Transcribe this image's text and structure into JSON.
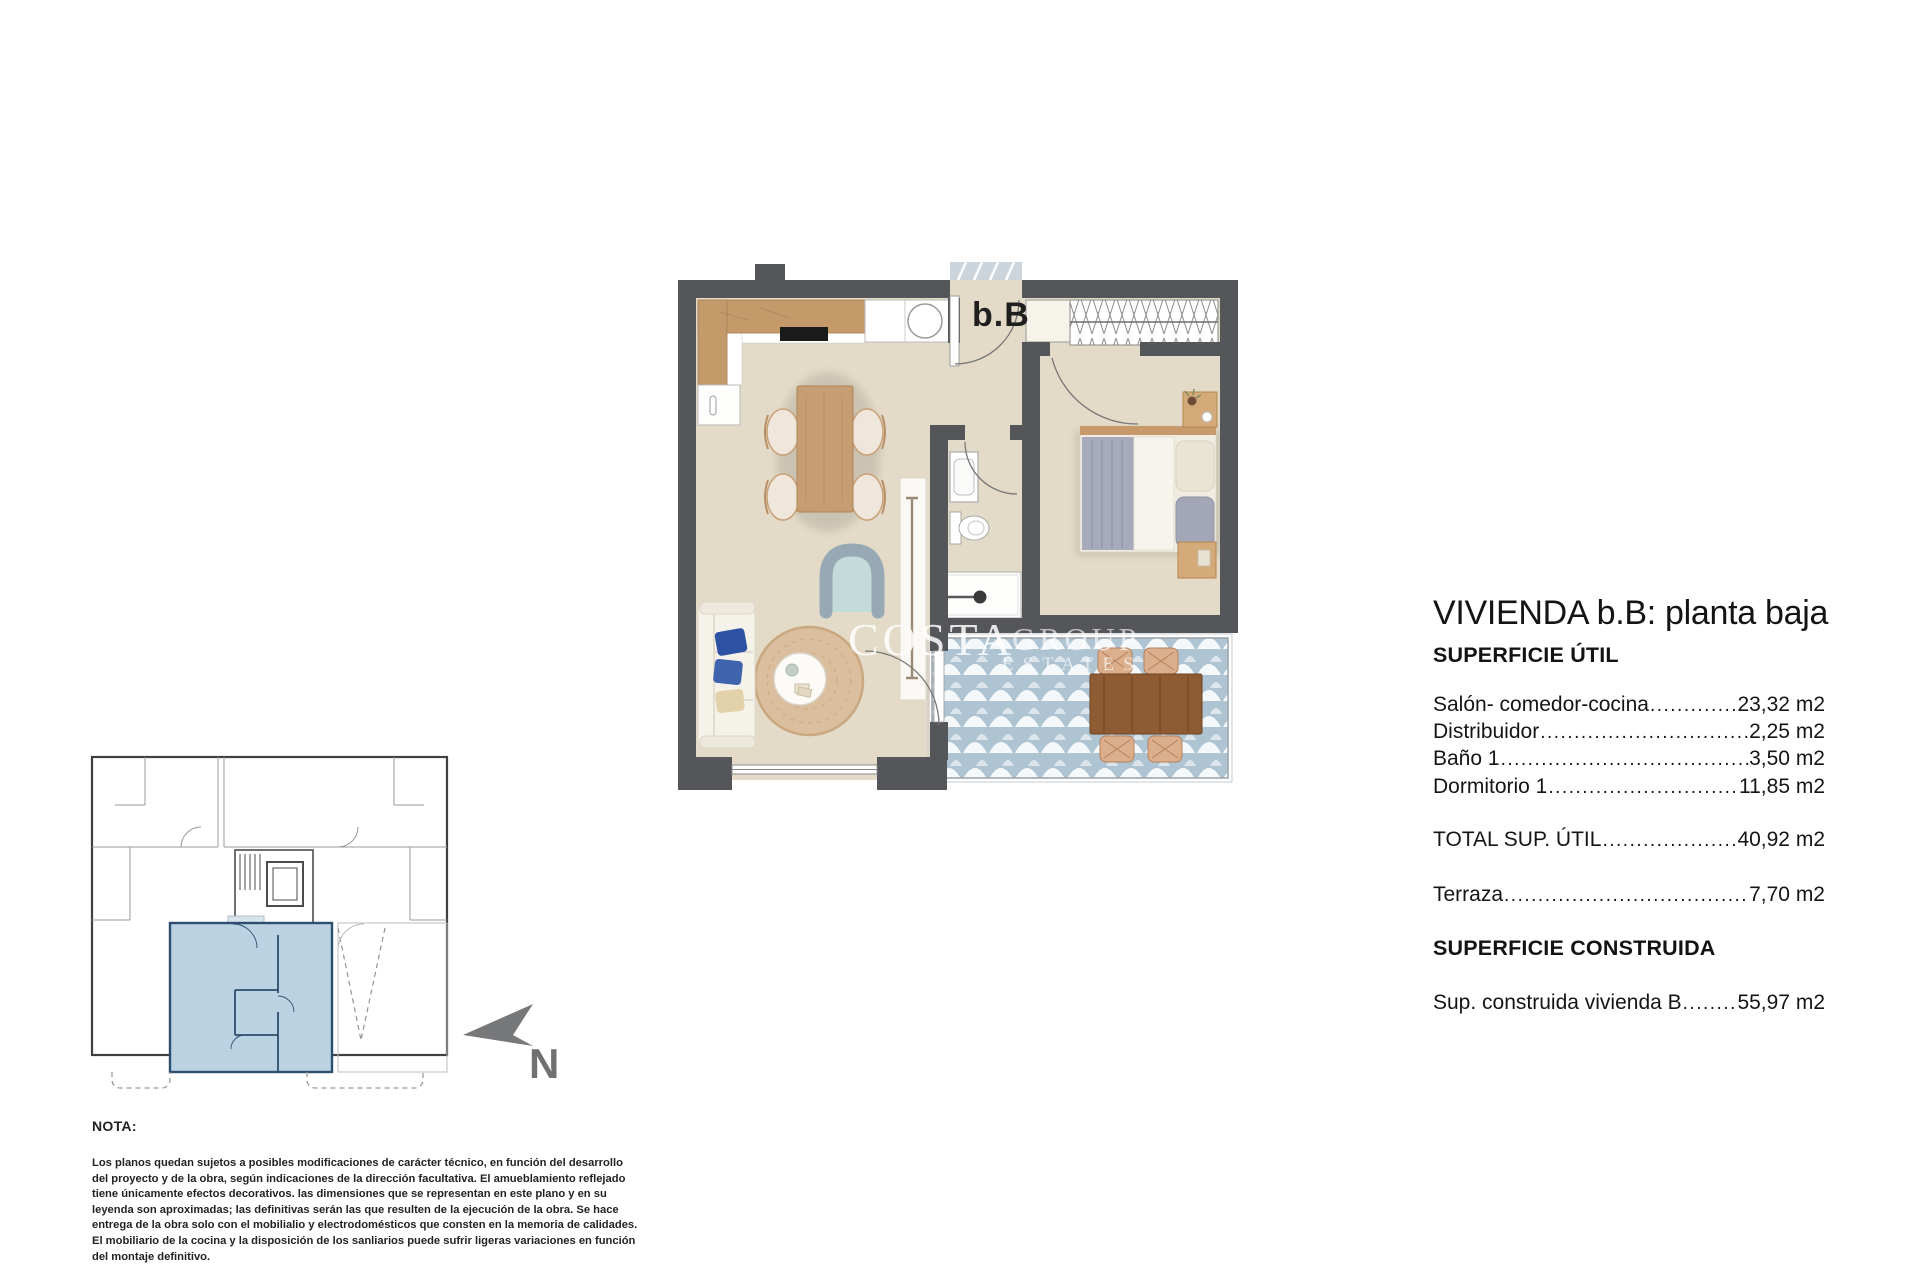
{
  "document": {
    "unit_label": "b.B",
    "north_label": "N",
    "watermark": {
      "word1": "COSTA",
      "word2": "GROUP",
      "word3": "ESTATES"
    }
  },
  "summary": {
    "title": "VIVIENDA b.B: planta baja",
    "section_util_heading": "SUPERFICIE ÚTIL",
    "rows": [
      {
        "label": "Salón- comedor-cocina",
        "value": "23,32 m2"
      },
      {
        "label": "Distribuidor",
        "value": "2,25 m2"
      },
      {
        "label": "Baño 1",
        "value": "3,50 m2"
      },
      {
        "label": "Dormitorio 1",
        "value": "11,85 m2"
      }
    ],
    "total_row": {
      "label": "TOTAL SUP. ÚTIL",
      "value": "40,92 m2"
    },
    "terraza_row": {
      "label": "Terraza",
      "value": "7,70 m2"
    },
    "section_construida_heading": "SUPERFICIE CONSTRUIDA",
    "construida_row": {
      "label": "Sup. construida vivienda B",
      "value": "55,97 m2"
    },
    "leader_dots": "...................................................................................................................."
  },
  "note": {
    "heading": "NOTA:",
    "lines": [
      "Los planos quedan sujetos a posibles modificaciones de carácter técnico, en función del desarrollo",
      "del proyecto y de la obra, según indicaciones de la dirección facultativa. El amueblamiento reflejado",
      "tiene únicamente efectos decorativos. las dimensiones que se representan en este plano y en su",
      "leyenda son aproximadas; las definitivas serán las que resulten de la ejecución de la obra. Se hace",
      "entrega de la obra solo con el mobilialio y electrodomésticos que consten en la memoria de calidades.",
      "El mobiliario de la cocina y la disposición de los sanliarios puede sufrir ligeras variaciones en función",
      "del montaje definitivo."
    ]
  },
  "colors": {
    "wall": "#54565A",
    "floor": "#E3DBC7",
    "wood": "#C49A6B",
    "terrace_tile": "#AEC4D2",
    "highlighted_unit": "#BBD2E3",
    "highlight_outline": "#2E4E6F",
    "north_arrow": "#77787A",
    "watermark": "#FFFFFF"
  }
}
